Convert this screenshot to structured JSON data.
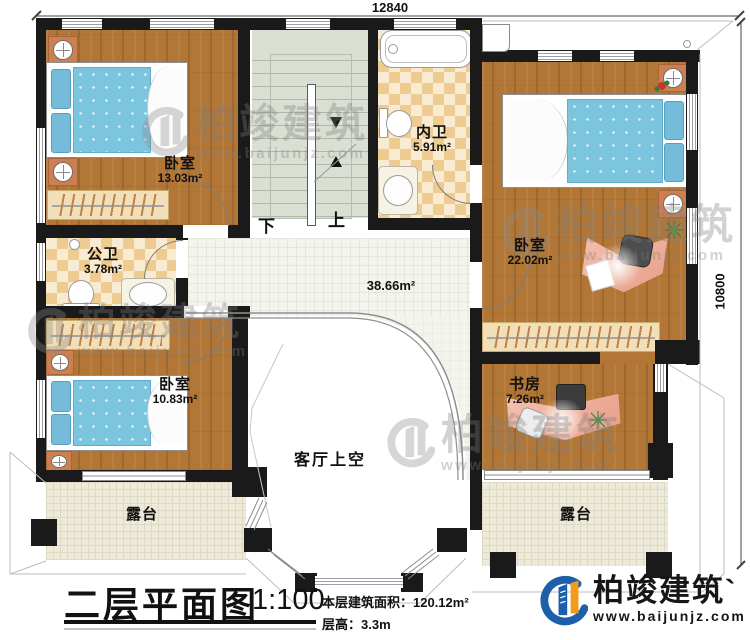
{
  "dimensions": {
    "top": "12840",
    "right": "10800"
  },
  "rooms": {
    "bedroom1": {
      "label": "卧室",
      "area": "13.03m²"
    },
    "bathroom_public": {
      "label": "公卫",
      "area": "3.78m²"
    },
    "bathroom_ensuite": {
      "label": "内卫",
      "area": "5.91m²"
    },
    "bedroom2": {
      "label": "卧室",
      "area": "22.02m²"
    },
    "bedroom3": {
      "label": "卧室",
      "area": "10.83m²"
    },
    "study": {
      "label": "书房",
      "area": "7.26m²"
    },
    "hall": {
      "area": "38.66m²"
    },
    "void": {
      "label": "客厅上空"
    },
    "terrace_left": {
      "label": "露台"
    },
    "terrace_right": {
      "label": "露台"
    }
  },
  "stairs": {
    "up": "上",
    "down": "下"
  },
  "footer": {
    "title": "二层平面图",
    "scale": "1:100",
    "area_line": "本层建筑面积：120.12m²",
    "height_line": "层高：3.3m"
  },
  "logo": {
    "brand": "柏竣建筑",
    "mark": "`",
    "site": "www.baijunjz.com"
  },
  "watermark": {
    "brand": "柏竣建筑",
    "site": "www.baijunjz.com"
  },
  "colors": {
    "wall": "#1a1a1a",
    "wood_floor": "#b27737",
    "bath_tile": "#eecb90",
    "stair": "#d9dfd3",
    "hall_tile": "#f4f4ef",
    "terrace": "#edead9",
    "bed_blue": "#7cc5de",
    "brand_blue": "#1c60aa",
    "brand_orange": "#f39a1d"
  }
}
